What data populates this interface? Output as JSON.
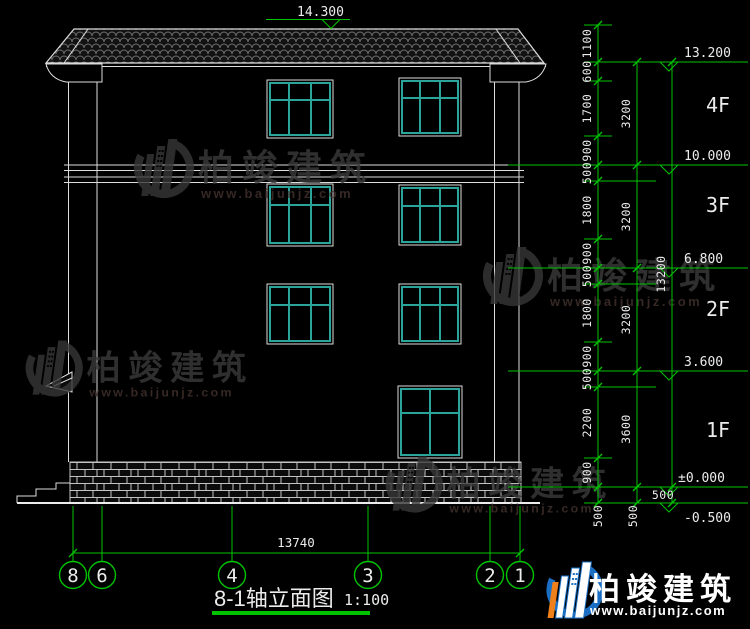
{
  "drawing": {
    "title": "8-1轴立面图",
    "scale": "1:100",
    "top_elevation": "14.300",
    "total_width_dim": "13740"
  },
  "elevations": {
    "e13200": "13.200",
    "e10000": "10.000",
    "e6800": "6.800",
    "e3600": "3.600",
    "e0": "±0.000",
    "em500": "-0.500"
  },
  "floors": {
    "f4": "4F",
    "f3": "3F",
    "f2": "2F",
    "f1": "1F"
  },
  "dims": {
    "chain1": [
      "1100",
      "600",
      "1700",
      "900",
      "500",
      "1800",
      "900",
      "500",
      "1800",
      "900",
      "500",
      "2200",
      "900",
      "500"
    ],
    "chain2": [
      "3200",
      "3200",
      "3200",
      "3600",
      "500"
    ],
    "chain3": [
      "13200",
      "500"
    ]
  },
  "axes": [
    "8",
    "6",
    "4",
    "3",
    "2",
    "1"
  ],
  "watermark": {
    "name": "柏竣建筑",
    "url": "www.baijunjz.com"
  },
  "colors": {
    "dim_green": "#00c400",
    "window_teal": "#2ba49c",
    "logo_blue": "#1a6fc4",
    "logo_orange": "#f08019"
  }
}
